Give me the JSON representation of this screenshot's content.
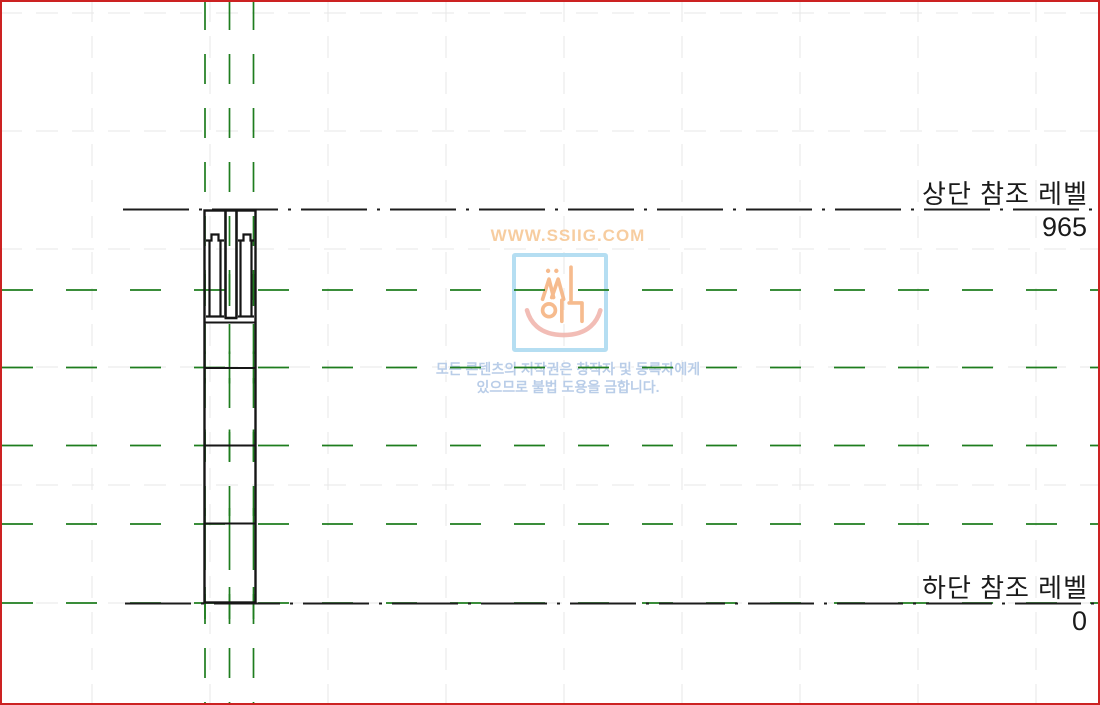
{
  "view": {
    "description": "column-family-elevation-view",
    "border_color": "#cc2222",
    "background_color": "#ffffff"
  },
  "levels": {
    "upper": {
      "label": "상단 참조 레벨",
      "value": "965"
    },
    "lower": {
      "label": "하단 참조 레벨",
      "value": "0"
    }
  },
  "reference_planes": {
    "color": "#1e7d1e",
    "vertical_x": [
      205,
      229.5,
      253.5
    ],
    "horizontal_y": [
      290,
      367.5,
      445.5,
      524,
      603
    ]
  },
  "level_lines": {
    "color": "#1c1c1c",
    "upper_y": 209.5,
    "lower_y": 603.5
  },
  "column": {
    "color": "#161616",
    "left": 204.5,
    "right": 255.5,
    "top": 210.5,
    "bottom": 603,
    "division_y": [
      322.5,
      368,
      445.5,
      523.5
    ]
  },
  "grid": {
    "color": "#e7e7e7"
  },
  "watermark": {
    "site": "WWW.SSIIG.COM",
    "site_color": "#f7cda0",
    "logo": "smiley-face-logo",
    "logo_border_color": "#b5def2",
    "logo_glyph_color": "#f5ab72",
    "smile_color": "#f1b6ae",
    "note_line1": "모든 콘텐츠의 저작권은 창작자 및 등록자에게",
    "note_line2": "있으므로 불법 도용을 금합니다.",
    "note_color": "#b9cde8"
  }
}
